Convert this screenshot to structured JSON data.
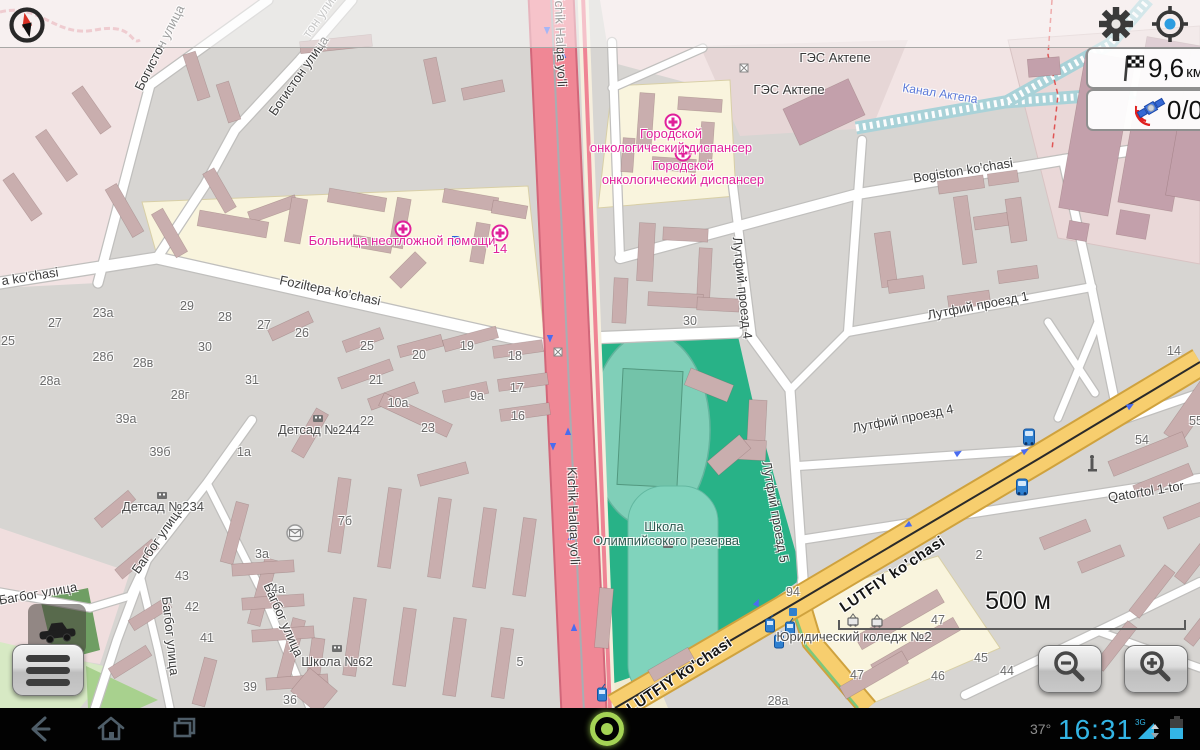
{
  "nav_panel": {
    "distance_value": "9,6",
    "distance_unit": "км",
    "satellite_count": "0/0"
  },
  "status_bar": {
    "temperature": "37°",
    "time": "16:31",
    "network_type": "3G"
  },
  "scale_bar": {
    "label": "500 м"
  },
  "icons": {
    "top_left": "compass-north-icon",
    "settings": "gear-icon",
    "locate": "crosshair-gps-icon",
    "distance": "checkered-flag-icon",
    "gps_panel": "satellite-icon",
    "menu": "hamburger-menu-icon",
    "profile": "car-icon",
    "zoom_out": "magnifier-minus-icon",
    "zoom_in": "magnifier-plus-icon",
    "nav_back": "back-arrow-icon",
    "nav_home": "home-icon",
    "nav_recents": "recent-apps-icon",
    "record": "record-ring-icon",
    "signal": "signal-3g-icon",
    "battery": "battery-icon"
  },
  "colors": {
    "holo_blue": "#33b5e5",
    "park_green": "#28b287",
    "road_yellow": "#f7ce6e",
    "trunk_red": "#f08795",
    "poi_magenta": "#e0219a",
    "canal_blue": "#a9d2d8",
    "cream_area": "#f9f4dd",
    "building": "#c9aeae"
  },
  "map_labels": {
    "streets": [
      {
        "t": "Богистон улица",
        "x": 160,
        "y": 48,
        "r": -63
      },
      {
        "t": "Богистон улица",
        "x": 299,
        "y": 76,
        "r": -55
      },
      {
        "t": "тон улица",
        "x": 323,
        "y": 12,
        "r": -55,
        "s": "stf"
      },
      {
        "t": "a ko'chasi",
        "x": 30,
        "y": 277,
        "r": -9
      },
      {
        "t": "Foziltepa ko'chasi",
        "x": 330,
        "y": 291,
        "r": 12
      },
      {
        "t": "Kichik Halqa yo'li",
        "x": 560,
        "y": 38,
        "r": 88
      },
      {
        "t": "Kichik Halqa yo'li",
        "x": 573,
        "y": 516,
        "r": 88
      },
      {
        "t": "Bogiston ko'chasi",
        "x": 963,
        "y": 171,
        "r": -9
      },
      {
        "t": "Лутфий проезд 1",
        "x": 978,
        "y": 306,
        "r": -11
      },
      {
        "t": "Лутфий проезд 4",
        "x": 742,
        "y": 288,
        "r": 84
      },
      {
        "t": "Лутфий проезд 5",
        "x": 775,
        "y": 512,
        "r": 80
      },
      {
        "t": "Лутфий проезд 4",
        "x": 903,
        "y": 419,
        "r": -11
      },
      {
        "t": "Qatortol 1-tor",
        "x": 1146,
        "y": 492,
        "r": -9
      },
      {
        "t": "LUTFIY ko'chasi",
        "x": 893,
        "y": 575,
        "r": -34,
        "s": "rd"
      },
      {
        "t": "LUTFIY ko'chasi",
        "x": 680,
        "y": 676,
        "r": -34,
        "s": "rd"
      },
      {
        "t": "Багбог улица",
        "x": 158,
        "y": 540,
        "r": -55
      },
      {
        "t": "Багбог улица",
        "x": 170,
        "y": 636,
        "r": 84
      },
      {
        "t": "Багбог улица",
        "x": 283,
        "y": 620,
        "r": 66
      },
      {
        "t": "Багбог улица",
        "x": 38,
        "y": 594,
        "r": -10
      },
      {
        "t": "Канал Актепа",
        "x": 940,
        "y": 94,
        "r": 9,
        "s": "wt"
      }
    ],
    "house_numbers": [
      [
        "25",
        8,
        342
      ],
      [
        "27",
        55,
        324
      ],
      [
        "23a",
        103,
        314
      ],
      [
        "29",
        187,
        307
      ],
      [
        "28",
        225,
        318
      ],
      [
        "27",
        264,
        326
      ],
      [
        "28б",
        103,
        358
      ],
      [
        "28в",
        143,
        364
      ],
      [
        "30",
        205,
        348
      ],
      [
        "28a",
        50,
        382
      ],
      [
        "31",
        252,
        381
      ],
      [
        "28г",
        180,
        396
      ],
      [
        "39а",
        126,
        420
      ],
      [
        "39б",
        160,
        453
      ],
      [
        "26",
        302,
        334
      ],
      [
        "25",
        367,
        347
      ],
      [
        "20",
        419,
        356
      ],
      [
        "19",
        467,
        347
      ],
      [
        "18",
        515,
        357
      ],
      [
        "21",
        376,
        381
      ],
      [
        "17",
        517,
        389
      ],
      [
        "10a",
        398,
        404
      ],
      [
        "9a",
        477,
        397
      ],
      [
        "16",
        518,
        417
      ],
      [
        "22",
        367,
        422
      ],
      [
        "23",
        428,
        429
      ],
      [
        "30",
        690,
        322
      ],
      [
        "1a",
        244,
        453
      ],
      [
        "3a",
        262,
        555
      ],
      [
        "4a",
        278,
        590
      ],
      [
        "43",
        182,
        577
      ],
      [
        "42",
        192,
        608
      ],
      [
        "41",
        207,
        639
      ],
      [
        "39",
        250,
        688
      ],
      [
        "7б",
        345,
        522
      ],
      [
        "5",
        520,
        663
      ],
      [
        "36",
        290,
        701
      ],
      [
        "94",
        793,
        593
      ],
      [
        "47",
        938,
        621
      ],
      [
        "47",
        857,
        676
      ],
      [
        "46",
        938,
        677
      ],
      [
        "45",
        981,
        659
      ],
      [
        "44",
        1007,
        672
      ],
      [
        "28a",
        778,
        702
      ],
      [
        "2",
        979,
        556
      ],
      [
        "14",
        1174,
        352
      ],
      [
        "54",
        1142,
        441
      ],
      [
        "55",
        1196,
        422
      ]
    ],
    "places": [
      {
        "t": "Больница неотложной помощи",
        "x": 402,
        "y": 241,
        "s": "mg"
      },
      {
        "t": "14",
        "x": 500,
        "y": 249,
        "s": "mg"
      },
      {
        "t": "Городской",
        "x": 671,
        "y": 134,
        "s": "mg"
      },
      {
        "t": "онкологический диспансер",
        "x": 671,
        "y": 148,
        "s": "mg"
      },
      {
        "t": "Городской",
        "x": 683,
        "y": 166,
        "s": "mg"
      },
      {
        "t": "онкологический диспансер",
        "x": 683,
        "y": 180,
        "s": "mg"
      },
      {
        "t": "ГЭС Актепе",
        "x": 835,
        "y": 58,
        "s": "blk"
      },
      {
        "t": "ГЭС Актепе",
        "x": 789,
        "y": 90,
        "s": "blk"
      },
      {
        "t": "Детсад №244",
        "x": 319,
        "y": 430,
        "s": "poi"
      },
      {
        "t": "Детсад №234",
        "x": 163,
        "y": 507,
        "s": "poi"
      },
      {
        "t": "Школа №62",
        "x": 337,
        "y": 662,
        "s": "poi"
      },
      {
        "t": "Юридический коледж №2",
        "x": 854,
        "y": 637,
        "s": "poi"
      },
      {
        "t": "Школа",
        "x": 664,
        "y": 527,
        "s": "park"
      },
      {
        "t": "Олимпийсокого резерва",
        "x": 666,
        "y": 541,
        "s": "park"
      }
    ]
  }
}
